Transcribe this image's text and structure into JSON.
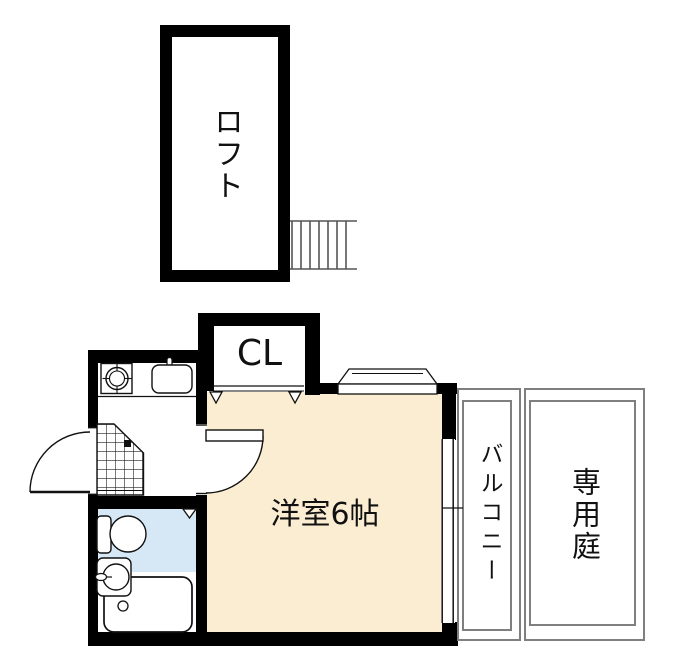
{
  "floorplan": {
    "loft": {
      "label": "ロフト"
    },
    "closet": {
      "label": "CL"
    },
    "room": {
      "label": "洋室6帖"
    },
    "balcony": {
      "label": "バルコニー"
    },
    "garden": {
      "label": "専用庭"
    },
    "colors": {
      "room_fill": "#FBEDD2",
      "bath_fill": "#D6E8F5",
      "wall": "#000000",
      "outline_gray": "#7F7F7F"
    }
  }
}
